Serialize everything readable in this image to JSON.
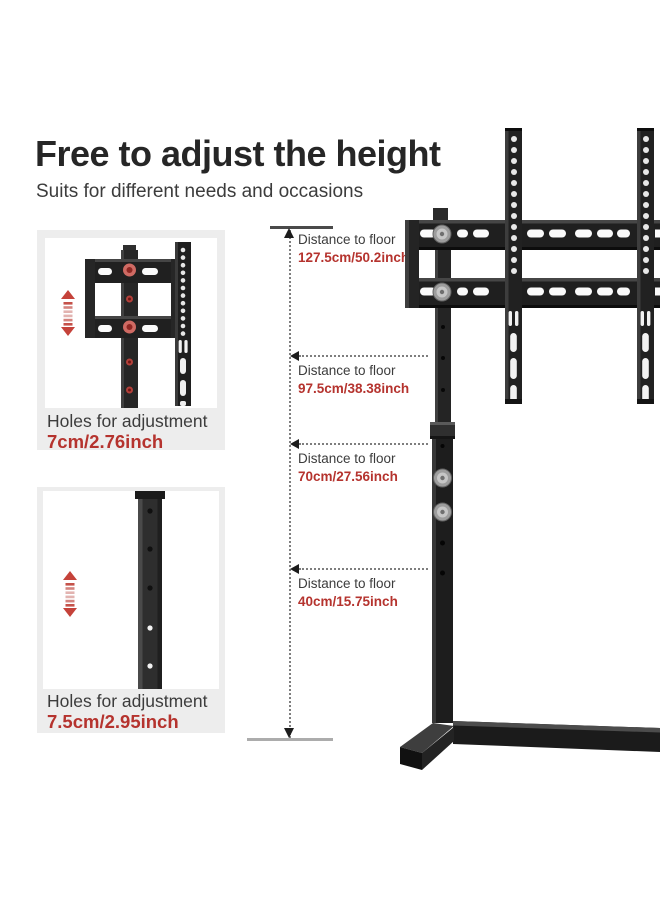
{
  "header": {
    "title": "Free to adjust the height",
    "subtitle": "Suits for different needs and occasions"
  },
  "inset_panels": [
    {
      "caption": "Holes for adjustment",
      "value": "7cm/2.76inch",
      "illustration": "tv-bracket-close-up"
    },
    {
      "caption": "Holes for adjustment",
      "value": "7.5cm/2.95inch",
      "illustration": "pole-close-up"
    }
  ],
  "measurements": [
    {
      "label": "Distance to floor",
      "value": "127.5cm/50.2inch"
    },
    {
      "label": "Distance to floor",
      "value": "97.5cm/38.38inch"
    },
    {
      "label": "Distance to floor",
      "value": "70cm/27.56inch"
    },
    {
      "label": "Distance to floor",
      "value": "40cm/15.75inch"
    }
  ],
  "icons": {
    "adjust_updown_icon": "red stacked up/down arrows with dashes",
    "dimension_arrow_up": "▲",
    "dimension_arrow_down": "▼",
    "dimension_arrow_left": "◀"
  },
  "colors": {
    "accent_red": "#b5332e",
    "icon_red": "#c5423a",
    "heading": "#262626",
    "body_text": "#3c3c3c",
    "panel_bg": "#ededed",
    "product_black": "#1e1e1e",
    "dimension_line": "#7e7e7e"
  }
}
